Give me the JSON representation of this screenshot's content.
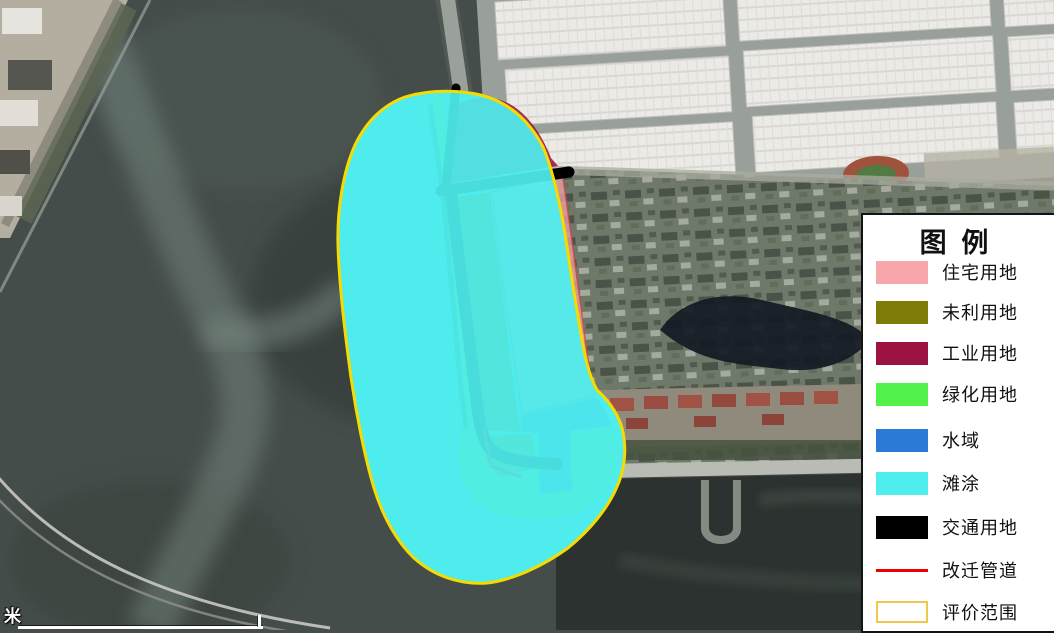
{
  "legend": {
    "title": "图 例",
    "items": [
      {
        "key": "residential",
        "label": "住宅用地",
        "color": "#F7A6AC",
        "type": "fill"
      },
      {
        "key": "unused",
        "label": "未利用地",
        "color": "#7E7B09",
        "type": "fill"
      },
      {
        "key": "industrial",
        "label": "工业用地",
        "color": "#9C1243",
        "type": "fill"
      },
      {
        "key": "green",
        "label": "绿化用地",
        "color": "#52F24B",
        "type": "fill"
      },
      {
        "key": "water",
        "label": "水域",
        "color": "#2B7BD6",
        "type": "fill"
      },
      {
        "key": "tidal",
        "label": "滩涂",
        "color": "#4FEDED",
        "type": "fill"
      },
      {
        "key": "traffic",
        "label": "交通用地",
        "color": "#000000",
        "type": "fill"
      },
      {
        "key": "pipeline",
        "label": "改迁管道",
        "color": "#E80202",
        "type": "line"
      },
      {
        "key": "boundary",
        "label": "评价范围",
        "color": "#F0C84A",
        "type": "outline"
      }
    ]
  },
  "map": {
    "boundary_line_color": "#F6DB00",
    "regions": [
      {
        "name": "tidal-flat",
        "legend_key": "tidal"
      },
      {
        "name": "industrial-area",
        "legend_key": "industrial"
      },
      {
        "name": "unused-land",
        "legend_key": "unused"
      },
      {
        "name": "residential-area",
        "legend_key": "residential"
      },
      {
        "name": "water-area",
        "legend_key": "water"
      },
      {
        "name": "green-area",
        "legend_key": "green"
      },
      {
        "name": "traffic-road",
        "legend_key": "traffic"
      },
      {
        "name": "relocated-pipeline",
        "legend_key": "pipeline"
      },
      {
        "name": "evaluation-boundary",
        "legend_key": "boundary"
      }
    ]
  },
  "scale_bar": {
    "unit_label": "米"
  }
}
